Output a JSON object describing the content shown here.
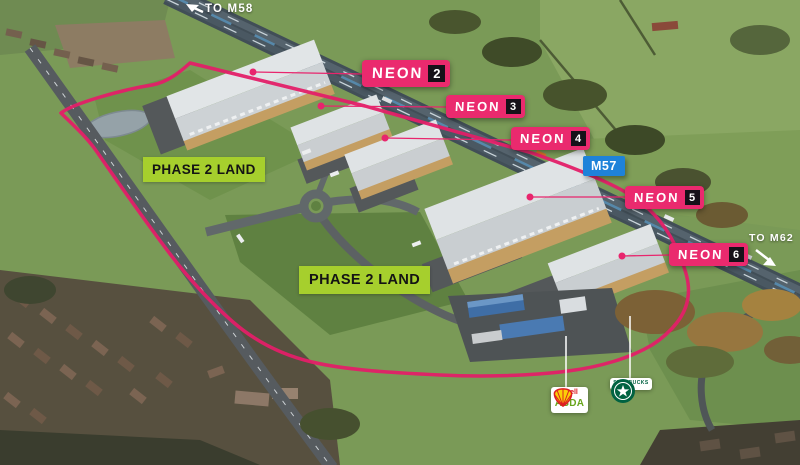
{
  "directions": {
    "m58": "TO M58",
    "m62": "TO M62"
  },
  "units": [
    {
      "brand": "NEON",
      "number": "2"
    },
    {
      "brand": "NEON",
      "number": "3"
    },
    {
      "brand": "NEON",
      "number": "4"
    },
    {
      "brand": "NEON",
      "number": "5"
    },
    {
      "brand": "NEON",
      "number": "6"
    }
  ],
  "motorway": {
    "label": "M57"
  },
  "phase": {
    "label1": "PHASE 2 LAND",
    "label2": "PHASE 2 LAND"
  },
  "amenities": {
    "shell": "Shell",
    "asda": "ASDA",
    "starbucks": "STARBUCKS"
  },
  "colors": {
    "neon_pink": "#EA2A6E",
    "boundary_pink": "#E31F68",
    "unit_number_bg": "#161119",
    "phase_green": "#A6CF2D",
    "motorway_blue": "#1E82D9",
    "shell_red": "#DD1D21",
    "asda_green": "#68A51C",
    "starbucks_green": "#006241"
  }
}
